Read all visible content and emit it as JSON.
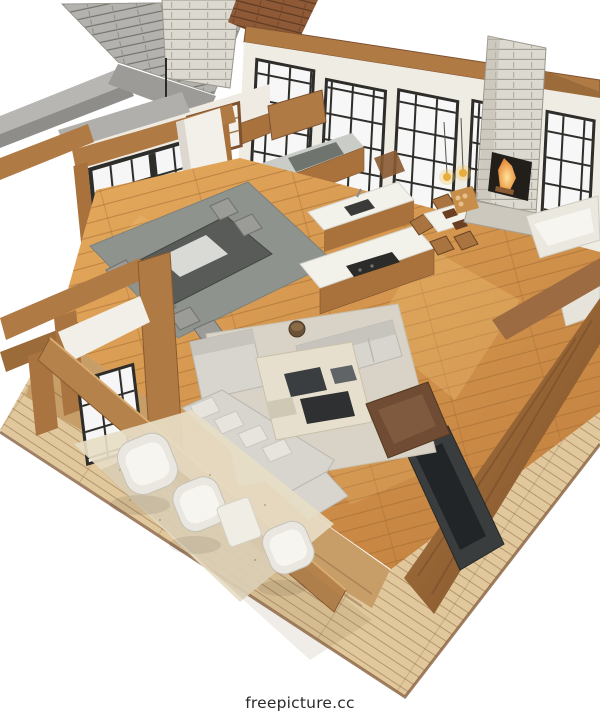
{
  "image": {
    "alt": "3D cutaway dollhouse rendering of an open-concept home interior seen from above",
    "areas": [
      "kitchen",
      "dining area",
      "great room / living room",
      "entry porch",
      "outdoor deck"
    ],
    "details": [
      "gray shingle roof section with stone chimney",
      "tall stone fireplace with lit firebox",
      "floor-to-ceiling black-framed windows",
      "timber post-and-beam frame",
      "hardwood flooring",
      "kitchen islands with sink and cooktop",
      "white dining table with pendant lights",
      "gray sectional sofas around a cream coffee table",
      "brown armchair and dark media wall",
      "wicker chairs on plank deck"
    ]
  },
  "watermark": {
    "text": "freepicture.cc"
  },
  "palette": {
    "wood": "#b07a45",
    "wood-dark": "#8a5a2e",
    "cabinet": "#a9723c",
    "frame-dark": "#2e2d2a",
    "glass": "#f6f7f6",
    "stone": "#dcd9d1",
    "roof-gray": "#b3b2ae",
    "roof-brown": "#8d5936",
    "counter": "#c9ccc7",
    "counter-white": "#f2f1ea",
    "table-dark": "#595b59",
    "rug-dining": "#8e938d",
    "rug-living": "#d8d3c6",
    "sofa": "#d7d5ce",
    "sofa-brown": "#6f4c33",
    "media": "#3a3d3e",
    "fire": "#e8891f",
    "deck": "#e0c79c",
    "floor-light": "#e6ab5e",
    "floor-dark": "#bf7d3c",
    "text": "#2b2b2b"
  }
}
